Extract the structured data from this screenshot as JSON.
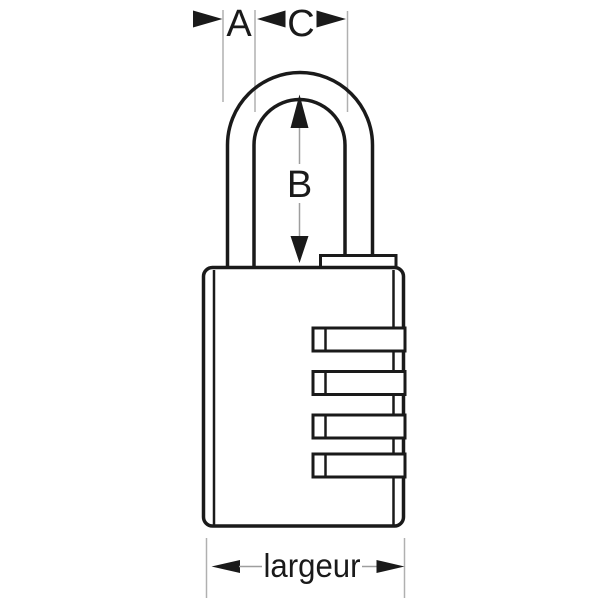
{
  "diagram": {
    "title": "padlock dimension drawing",
    "subject": "combination padlock with 4 dials and dimension annotations",
    "dimensions": {
      "a_label": "A",
      "b_label": "B",
      "c_label": "C",
      "width_label": "largeur"
    },
    "dial_count": 4,
    "colors": {
      "outline": "#1a1a1a",
      "extension_line": "#b0b0b0",
      "connector_line": "#9e9e9e",
      "background": "#ffffff"
    }
  }
}
